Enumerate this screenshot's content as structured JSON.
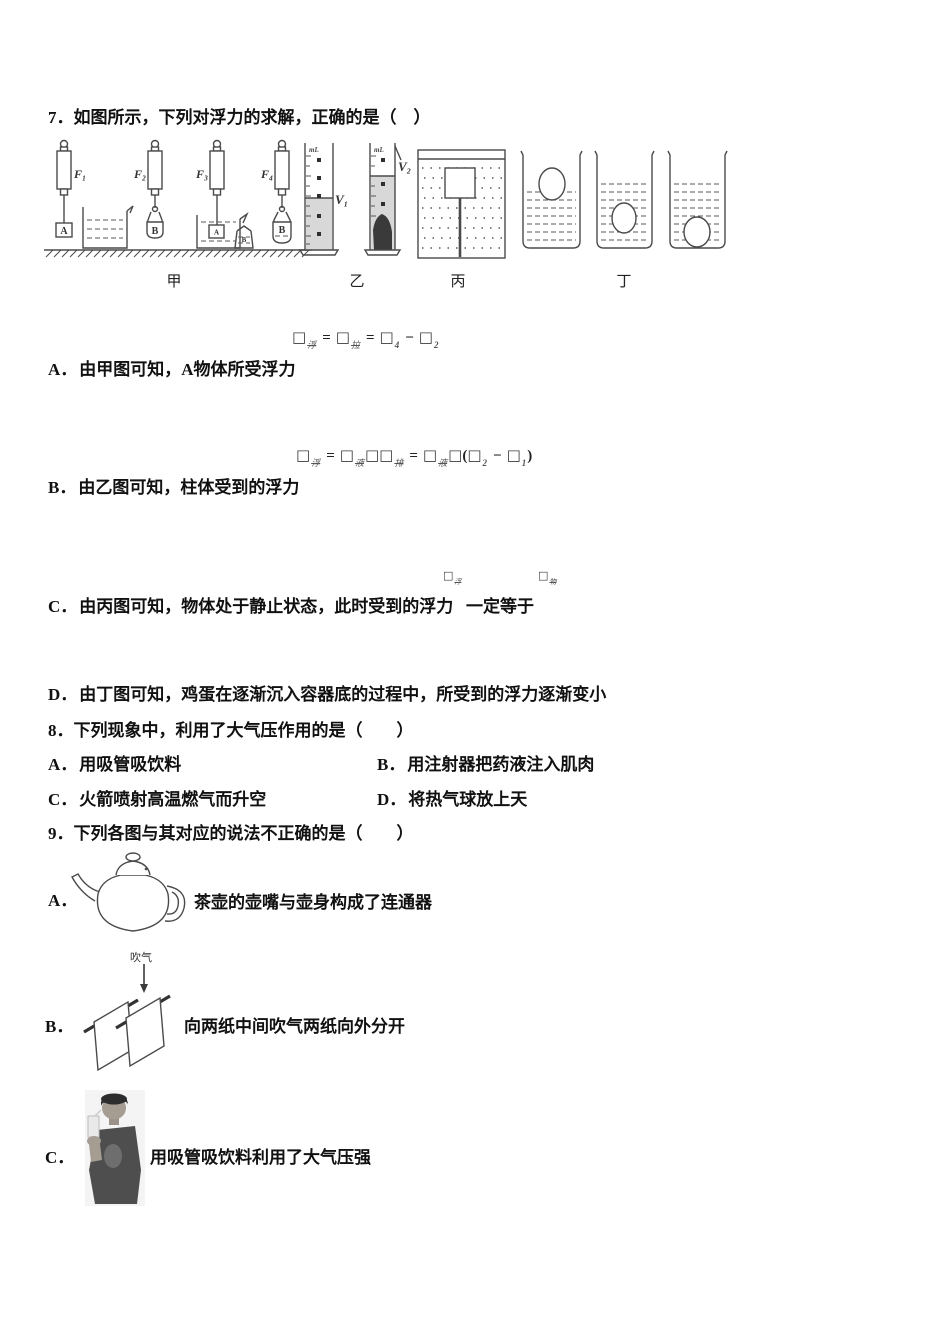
{
  "colors": {
    "text": "#111111",
    "figure_stroke": "#4a4a4a",
    "water_fill": "#d8d8d8",
    "stone_fill": "#3a3a3a"
  },
  "q7": {
    "title": "7．如图所示，下列对浮力的求解，正确的是（　）",
    "figure": {
      "scales": [
        "F₁",
        "F₂",
        "F₃",
        "F₄"
      ],
      "objects": {
        "block_a": "A",
        "bottle_b": "B",
        "block_a2": "A",
        "jar_b": "B",
        "bottle_b2": "B"
      },
      "ml1": "mL",
      "ml2": "mL",
      "volumes": [
        "V₁",
        "V₂"
      ],
      "groups": [
        "甲",
        "乙",
        "丙",
        "丁"
      ]
    },
    "options": [
      {
        "label": "A．",
        "text": "由甲图可知，A物体所受浮力",
        "formula": [
          "b:浮",
          "o:=",
          "b:拉",
          "o:=",
          "bn:4",
          "o:−",
          "bn:2"
        ]
      },
      {
        "label": "B．",
        "text": "由乙图可知，柱体受到的浮力",
        "formula": [
          "b:浮",
          "o:=",
          "b:液",
          "b",
          "b:排",
          "o:=",
          "b:液",
          "b",
          "p:(",
          "bn:2",
          "o:−",
          "bn:1",
          "p:)"
        ]
      },
      {
        "label": "C．",
        "text_before": "由丙图可知，物体处于静止状态，此时受到的浮力",
        "text_after": "一定等于",
        "formula1": [
          "b:浮"
        ],
        "formula2": [
          "b:物"
        ]
      },
      {
        "label": "D．",
        "text": "由丁图可知，鸡蛋在逐渐沉入容器底的过程中，所受到的浮力逐渐变小"
      }
    ]
  },
  "q8": {
    "title": "8．下列现象中，利用了大气压作用的是（　　）",
    "options": [
      {
        "label": "A．",
        "text": "用吸管吸饮料"
      },
      {
        "label": "B．",
        "text": "用注射器把药液注入肌肉"
      },
      {
        "label": "C．",
        "text": "火箭喷射高温燃气而升空"
      },
      {
        "label": "D．",
        "text": "将热气球放上天"
      }
    ]
  },
  "q9": {
    "title": "9．下列各图与其对应的说法不正确的是（　　）",
    "options": [
      {
        "label": "A．",
        "caption": "茶壶的壶嘴与壶身构成了连通器"
      },
      {
        "label": "B．",
        "caption": "向两纸中间吹气两纸向外分开",
        "figure_label": "吹气"
      },
      {
        "label": "C．",
        "caption": "用吸管吸饮料利用了大气压强"
      }
    ]
  }
}
